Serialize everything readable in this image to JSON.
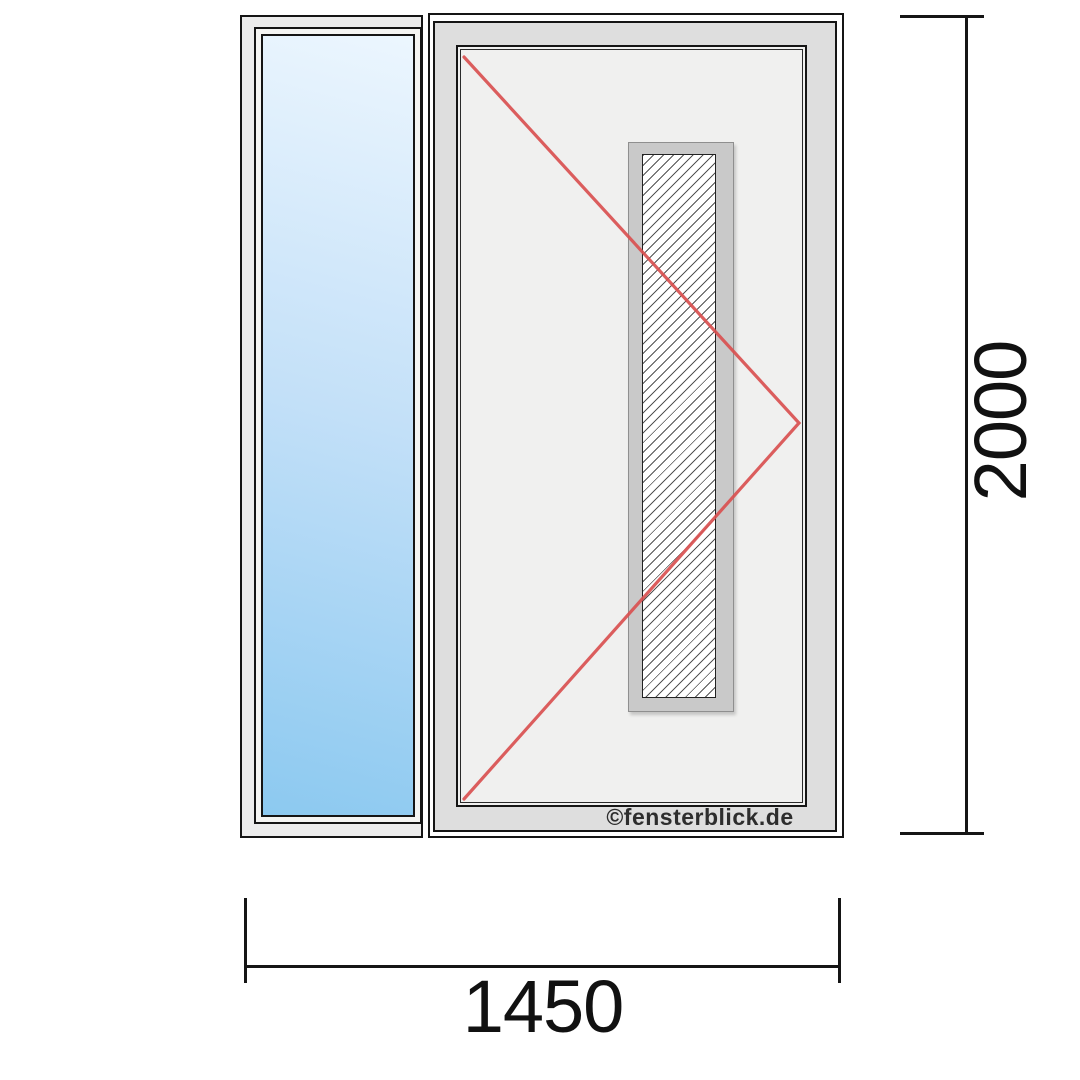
{
  "diagram": {
    "watermark": "©fensterblick.de",
    "dimensions": {
      "width_label": "1450",
      "height_label": "2000"
    },
    "colors": {
      "outline": "#151515",
      "frame_light": "#ececec",
      "frame_mid": "#f4f4f2",
      "frame_band": "#dedede",
      "leaf_face": "#f0f0ef",
      "hatch_surround": "#c9c9c9",
      "glass_top": "#ecf6fe",
      "glass_mid": "#c3e0f8",
      "glass_bottom": "#8cc9f0",
      "opening_line": "#d95050",
      "dim_line": "#151515",
      "watermark_color": "#2d2d2d"
    }
  }
}
